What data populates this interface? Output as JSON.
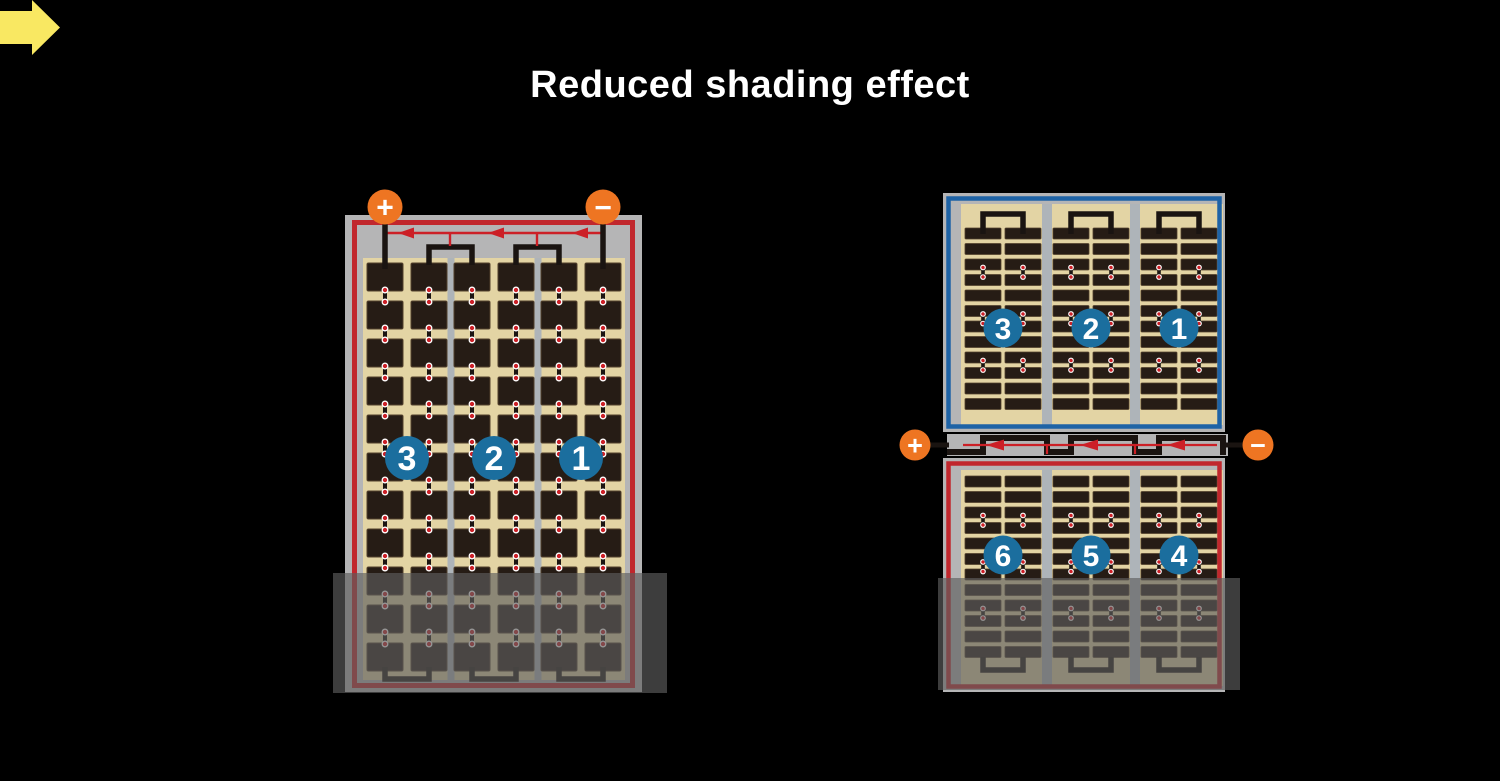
{
  "title": "Reduced shading effect",
  "left_module": {
    "terminals": {
      "positive": "+",
      "negative": "−"
    },
    "group_labels": [
      "3",
      "2",
      "1"
    ]
  },
  "right_module": {
    "terminals": {
      "positive": "+",
      "negative": "−"
    },
    "top_group_labels": [
      "3",
      "2",
      "1"
    ],
    "bottom_group_labels": [
      "6",
      "5",
      "4"
    ]
  },
  "colors": {
    "background": "#000000",
    "title_text": "#ffffff",
    "frame_gray": "#b5b5b6",
    "cell_backsheet_tan": "#e3d4a4",
    "cell_dark": "#261c15",
    "divider_gray": "#aeb4b9",
    "wire_red": "#c1272d",
    "diode_red": "#cc2027",
    "wire_blue": "#1e63a6",
    "terminal_orange": "#ee7522",
    "badge_blue": "#1b6e9e",
    "arrow_yellow": "#f9e862",
    "wire_black": "#1a1411",
    "shade_overlay": "rgba(94,94,94,0.65)"
  }
}
